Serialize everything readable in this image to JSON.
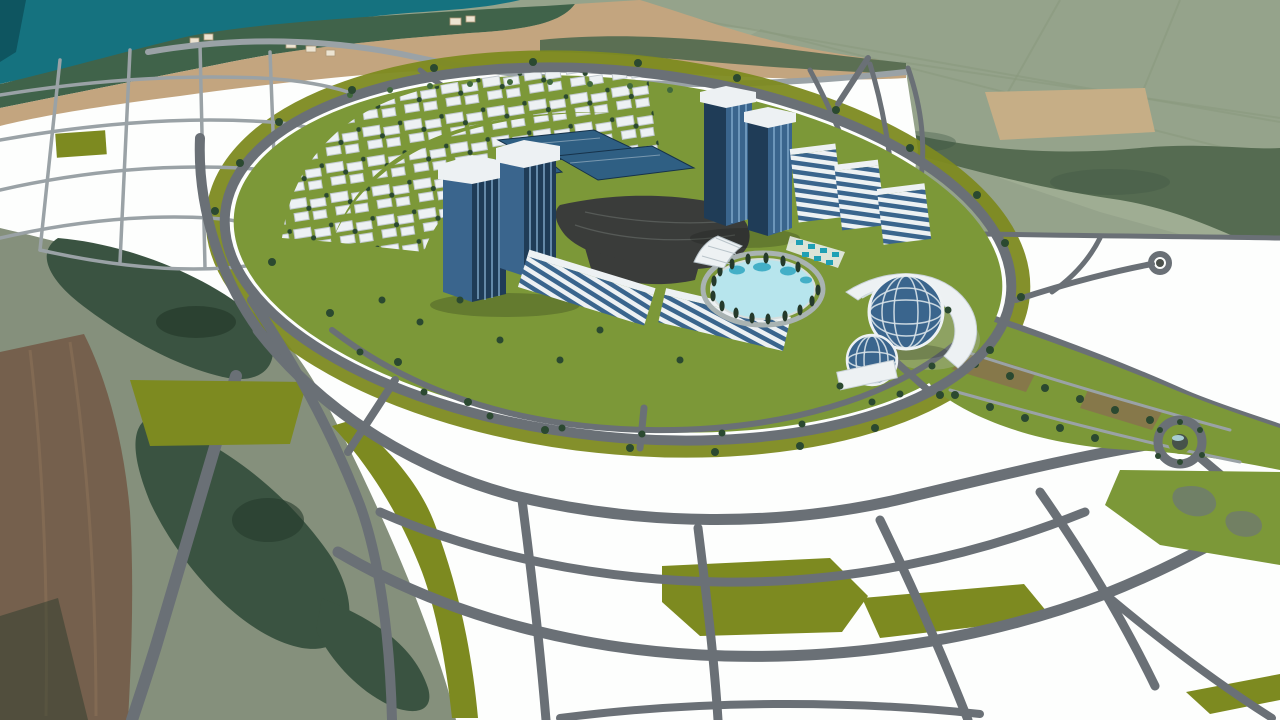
{
  "scene": {
    "title": "Aerial 3D rendering of a coastal city masterplan with an oval mixed-use development",
    "elements": [
      {
        "name": "water-bay",
        "label": "Sea bay"
      },
      {
        "name": "shoreline-vegetation",
        "label": "Shoreline vegetation band"
      },
      {
        "name": "beach-strip",
        "label": "Beach with small structures"
      },
      {
        "name": "farmland",
        "label": "Farmland and field boundaries"
      },
      {
        "name": "forest-patches",
        "label": "Forest and scrub terrain"
      },
      {
        "name": "white-parcels",
        "label": "Masterplan land parcels"
      },
      {
        "name": "road-network",
        "label": "Curvilinear road network"
      },
      {
        "name": "ring-road",
        "label": "Oval tree-lined ring road"
      },
      {
        "name": "residential-cluster",
        "label": "Low-rise residential courtyard blocks"
      },
      {
        "name": "office-tower-complex",
        "label": "Twin glass office towers with white caps"
      },
      {
        "name": "high-rise-towers",
        "label": "High-rise glass towers"
      },
      {
        "name": "midrise-slabs",
        "label": "Striped mid-rise slab buildings"
      },
      {
        "name": "terrace-blocks",
        "label": "Stepped terrace buildings"
      },
      {
        "name": "dome-pavilions",
        "label": "Glass dome pavilions with crescent building"
      },
      {
        "name": "lagoon-pool",
        "label": "Oval lagoon pool ringed by cypress trees"
      },
      {
        "name": "cabana-row",
        "label": "Teal pool cabanas"
      },
      {
        "name": "canopy-structure",
        "label": "White fan canopy"
      },
      {
        "name": "parking-plaza",
        "label": "Central dark parking plaza"
      },
      {
        "name": "park-boulevard",
        "label": "Landscaped boulevard with tree rows"
      },
      {
        "name": "roundabout",
        "label": "Landscaped roundabout"
      }
    ]
  },
  "colors": {
    "water": "#15727f",
    "waterDeep": "#0e5560",
    "shoreGreen": "#40634a",
    "beach": "#c3a57f",
    "hut": "#ece4d2",
    "fieldSage": "#95a38b",
    "fieldSageLight": "#a4b097",
    "fieldTan": "#c6ae86",
    "ridgeGreen": "#556b51",
    "scrub": "#85907c",
    "forest": "#3a5341",
    "forestDark": "#253a2b",
    "fieldBrown": "#75604d",
    "parcel": "#fdfefd",
    "road": "#6a7076",
    "roadLight": "#9aa2a6",
    "olive": "#7d8a20",
    "lawn": "#7c9838",
    "parking": "#3a3c3a",
    "glassDark": "#1f3c57",
    "glassMid": "#3a658d",
    "glassLight": "#85aecf",
    "buildingWhite": "#edf1f3",
    "roofBlue": "#2f5f83",
    "pondLight": "#b7e5ed",
    "pondDeep": "#2fa6c0",
    "cabana": "#1fa0b4",
    "treeDark": "#2b4930",
    "palm": "#41693c",
    "plazaBrown": "#8a6e50",
    "rock": "#6f7b6e"
  }
}
